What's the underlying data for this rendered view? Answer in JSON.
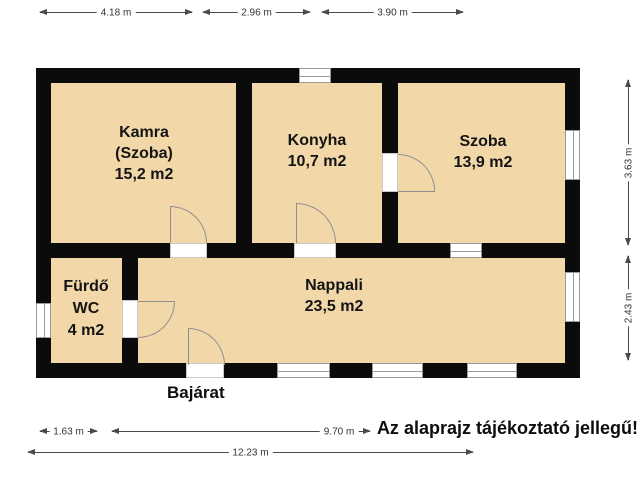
{
  "plan": {
    "rooms": [
      {
        "id": "kamra",
        "lines": [
          "Kamra",
          "(Szoba)",
          "15,2 m2"
        ]
      },
      {
        "id": "konyha",
        "lines": [
          "Konyha",
          "10,7 m2"
        ]
      },
      {
        "id": "szoba",
        "lines": [
          "Szoba",
          "13,9 m2"
        ]
      },
      {
        "id": "furdo",
        "lines": [
          "Fürdő",
          "WC",
          "4 m2"
        ]
      },
      {
        "id": "nappali",
        "lines": [
          "Nappali",
          "23,5 m2"
        ]
      }
    ],
    "entrance_label": "Bajárat",
    "disclaimer": "Az alaprajz tájékoztató jellegű!"
  },
  "dimensions": {
    "top": [
      "4.18 m",
      "2.96 m",
      "3.90 m"
    ],
    "right": [
      "3.63 m",
      "2.43 m"
    ],
    "bottom": [
      "1.63 m",
      "9.70 m",
      "12.23 m"
    ]
  },
  "colors": {
    "background": "#ffffff",
    "wall": "#0b0b0b",
    "room_fill": "#f2d8a8",
    "window_frame": "#9a9a9a",
    "door_line": "#8f8f8f",
    "dimension_line": "#4a4a4a",
    "text": "#141414"
  }
}
